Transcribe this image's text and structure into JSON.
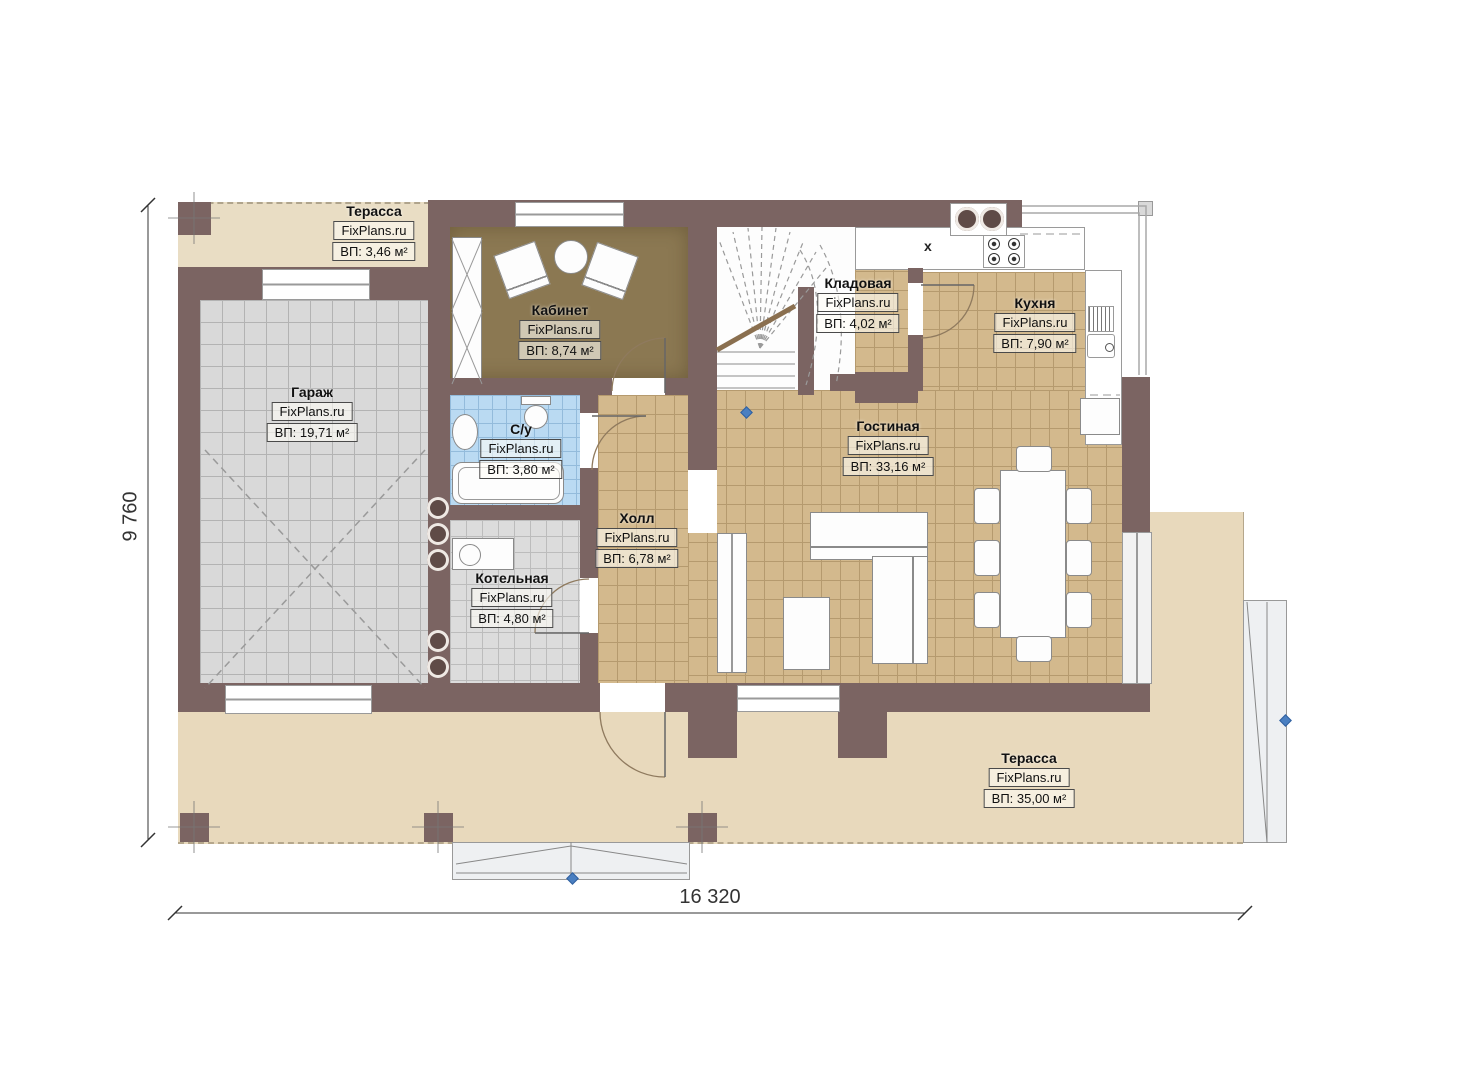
{
  "watermark": "FixPlans.ru",
  "rooms": [
    {
      "id": "terrace-top",
      "name": "Терасса",
      "area": "ВП: 3,46 м²"
    },
    {
      "id": "garage",
      "name": "Гараж",
      "area": "ВП: 19,71 м²"
    },
    {
      "id": "office",
      "name": "Кабинет",
      "area": "ВП: 8,74 м²"
    },
    {
      "id": "bathroom",
      "name": "С/у",
      "area": "ВП: 3,80 м²"
    },
    {
      "id": "boiler",
      "name": "Котельная",
      "area": "ВП: 4,80 м²"
    },
    {
      "id": "hall",
      "name": "Холл",
      "area": "ВП: 6,78 м²"
    },
    {
      "id": "storage",
      "name": "Кладовая",
      "area": "ВП: 4,02 м²"
    },
    {
      "id": "kitchen",
      "name": "Кухня",
      "area": "ВП: 7,90 м²"
    },
    {
      "id": "living",
      "name": "Гостиная",
      "area": "ВП: 33,16 м²"
    },
    {
      "id": "terrace-bottom",
      "name": "Терасса",
      "area": "ВП: 35,00 м²"
    }
  ],
  "dimensions": {
    "width_label": "16 320",
    "height_label": "9 760"
  },
  "symbols": {
    "kitchen_marker": "x"
  },
  "colors": {
    "wall": "#7b6462",
    "tan": "#d3b98d",
    "tan_line": "#b59a6e",
    "gray": "#d9d9d9",
    "gray_line": "#b3b3b3",
    "blue_tile": "#badaf2",
    "blue_tile_line": "#93bbdb",
    "office_floor": "#8b7852",
    "terrace": "#e9ddc4",
    "terrace_bottom": "#e8d9bc",
    "accent_blue": "#4a7fc1"
  }
}
